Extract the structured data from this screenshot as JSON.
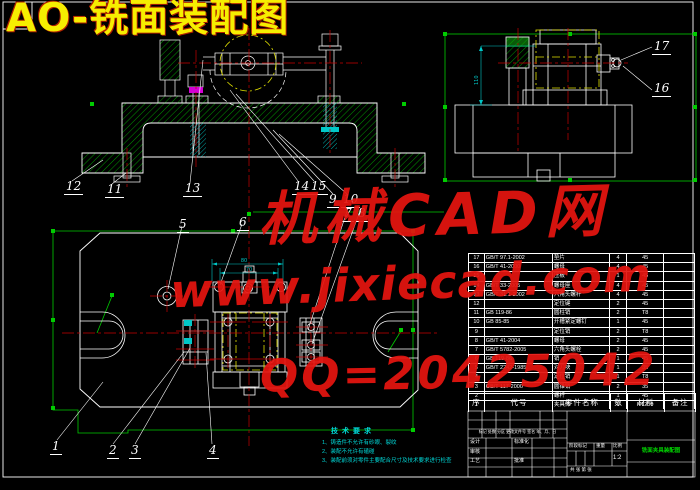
{
  "title": "AO-铣面装配图",
  "watermarks": {
    "brand": "机械CAD网",
    "url": "www.jixiecad.com",
    "qq": "QQ=20425042"
  },
  "callouts": [
    {
      "t": "12",
      "x": 64,
      "y": 180
    },
    {
      "t": "11",
      "x": 105,
      "y": 183
    },
    {
      "t": "13",
      "x": 183,
      "y": 182
    },
    {
      "t": "14",
      "x": 292,
      "y": 180
    },
    {
      "t": "15",
      "x": 309,
      "y": 180
    },
    {
      "t": "9",
      "x": 327,
      "y": 193
    },
    {
      "t": "10",
      "x": 341,
      "y": 193
    },
    {
      "t": "7",
      "x": 342,
      "y": 207
    },
    {
      "t": "8",
      "x": 356,
      "y": 207
    },
    {
      "t": "17",
      "x": 652,
      "y": 40
    },
    {
      "t": "16",
      "x": 652,
      "y": 82
    },
    {
      "t": "5",
      "x": 177,
      "y": 218
    },
    {
      "t": "6",
      "x": 237,
      "y": 216
    },
    {
      "t": "1",
      "x": 50,
      "y": 440
    },
    {
      "t": "2",
      "x": 107,
      "y": 444
    },
    {
      "t": "3",
      "x": 129,
      "y": 444
    },
    {
      "t": "4",
      "x": 207,
      "y": 444
    }
  ],
  "dims": {
    "dim_a": "80",
    "dim_b": "70",
    "dim_c": "110"
  },
  "tech_req": {
    "title": "技术要求",
    "items": [
      "1、铸造件不允许有砂眼、裂纹",
      "2、装配不允许有磕碰",
      "3、装配前须对零件主要配合尺寸及技术要求进行检查"
    ]
  },
  "parts_table": {
    "headers": [
      "序号",
      "代号",
      "零件名称",
      "数量",
      "材料",
      "备注"
    ],
    "rows": [
      [
        "17",
        "GB/T 97.1-2002",
        "垫片",
        "4",
        "45",
        ""
      ],
      [
        "16",
        "GB/T 41-2000",
        "螺母",
        "4",
        "45",
        ""
      ],
      [
        "15",
        "",
        "压板",
        "1",
        "45",
        ""
      ],
      [
        "14",
        "GB/T 33-2005",
        "螺母座",
        "4",
        "45",
        ""
      ],
      [
        "13",
        "GB/T 31.1-2002",
        "六角头螺杆",
        "4",
        "45",
        ""
      ],
      [
        "12",
        "",
        "定位键",
        "2",
        "45",
        ""
      ],
      [
        "11",
        "GB 119-86",
        "圆柱销",
        "2",
        "T8",
        ""
      ],
      [
        "10",
        "GB 85-85",
        "开槽紧定螺钉",
        "1",
        "45",
        ""
      ],
      [
        "9",
        "",
        "定位销",
        "2",
        "T8",
        ""
      ],
      [
        "8",
        "GB/T 41-2004",
        "螺母",
        "2",
        "45",
        ""
      ],
      [
        "7",
        "GB/T 5782-2005",
        "六角头螺栓",
        "2",
        "45",
        ""
      ],
      [
        "6",
        "GB 119-86",
        "销",
        "1",
        "45",
        ""
      ],
      [
        "5",
        "GB/T 2242-1985",
        "对刀块",
        "1",
        "35",
        ""
      ],
      [
        "4",
        "",
        "定位销",
        "1",
        "T8",
        ""
      ],
      [
        "3",
        "GB/T 117-2000",
        "圆锥销",
        "2",
        "35",
        ""
      ],
      [
        "2",
        "",
        "螺杆",
        "1",
        "45",
        ""
      ],
      [
        "1",
        "",
        "夹具体",
        "1",
        "HT200",
        ""
      ]
    ]
  },
  "title_block": {
    "mark_row": "标记 处数 分区 更改文件号 签名 年、月、日",
    "design": "设计",
    "check": "审核",
    "process": "工艺",
    "approve": "批准",
    "standard": "标准化",
    "stage_label": "阶段标记",
    "weight_label": "重量",
    "scale_label": "比例",
    "scale": "1:2",
    "sheet": "共 张 第 张",
    "drawing_name": "铣面夹具装配图"
  },
  "colors": {
    "line": "#ffffff",
    "hatch": "#00a800",
    "center": "#c80000",
    "detail": "#00d8d8",
    "phantom": "#e0e000",
    "grip": "#00cc00",
    "watermark": "#e61510"
  }
}
